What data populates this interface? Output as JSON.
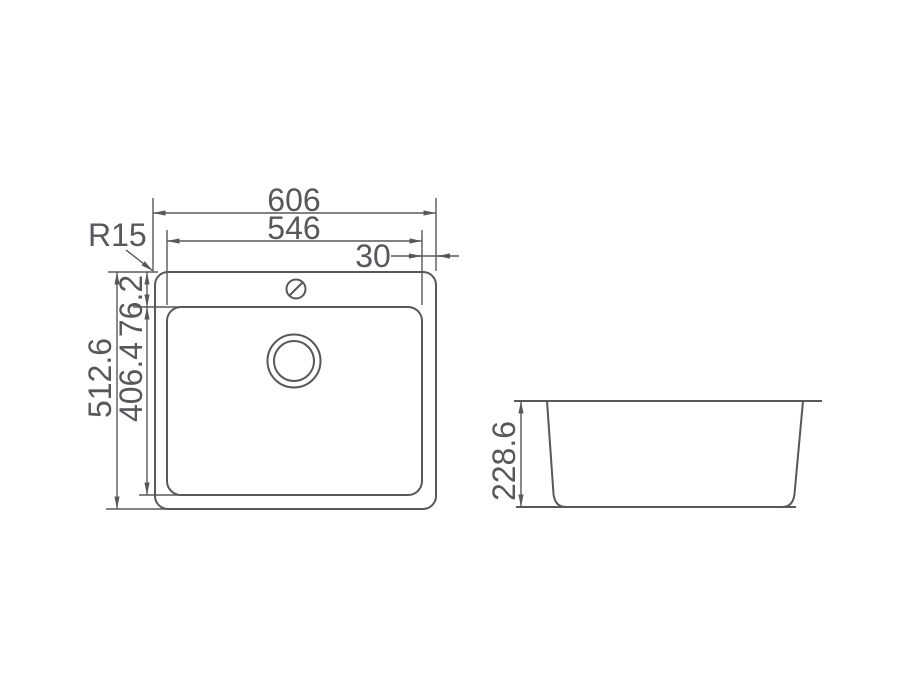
{
  "drawing": {
    "type": "sink-technical-drawing",
    "units": "mm",
    "colors": {
      "line": "#57585c",
      "text": "#57585c",
      "background": "#ffffff"
    }
  },
  "top_view": {
    "dim_overall_width": "606",
    "dim_bowl_width": "546",
    "dim_rim_offset": "30",
    "dim_corner_radius": "R15",
    "dim_overall_length": "512.6",
    "dim_bowl_length": "406.4",
    "dim_rim_to_bowl": "76.2"
  },
  "side_view": {
    "dim_bowl_depth": "228.6"
  }
}
